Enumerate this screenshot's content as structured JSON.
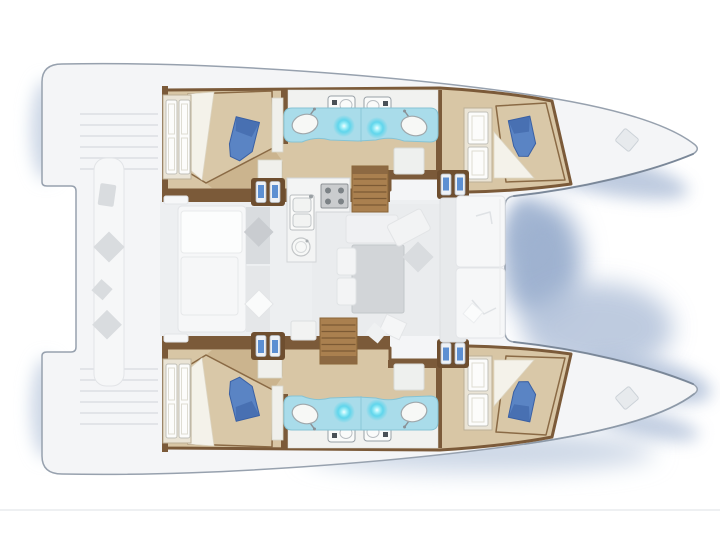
{
  "document": {
    "type": "floorplan-diagram",
    "subject": "catamaran yacht deck layout, top view",
    "orientation": "bows pointing right, twin hulls top and bottom",
    "visible_text": "none"
  },
  "colors": {
    "hullFill": "#f4f5f7",
    "hullStroke": "#97a1ae",
    "bowEdge": "#6e7c8e",
    "wallBrown": "#7b5a39",
    "floorTan": "#d8c6a5",
    "floorDark": "#c3a87e",
    "bedTan": "#d9c8a8",
    "bedOutline": "#8a6a45",
    "sheetWhite": "#f4f2ea",
    "cushionBlue": "#5a84c4",
    "cushionBlueDark": "#3a60a4",
    "wardrobeFrame": "#eae4d6",
    "doorWhite": "#fcfcfb",
    "doorStroke": "#c1c0b8",
    "bathBlue": "#a9dcea",
    "bathEdge": "#86c3d4",
    "glowCyan": "#49d7ee",
    "sinkWhite": "#f7f8f6",
    "sinkStroke": "#9fa7ab",
    "toiletWhite": "#fafbfa",
    "fixtureStroke": "#98a0a6",
    "fixtureDark": "#4a5157",
    "stepPanel": "#6e4e2f",
    "stepFace": "#eef1f5",
    "stepBlue": "#5c8fd2",
    "stairBrown": "#aa804f",
    "stairTread": "#7c5a34",
    "stairDark": "#8a6640",
    "furnWhite": "#f6f7f8",
    "furnStroke": "#e2e4e7",
    "furnGray": "#d9dcdf",
    "furnGrayDark": "#c9ccd0",
    "tableGray": "#d2d5d8",
    "stoveGray": "#caccce",
    "burnerDark": "#6f7479",
    "nightstand": "#f0f0ec",
    "deckLine": "#dcdfe3",
    "shadowDeep": "#9fb2d0",
    "shadowMid": "#b3c2da",
    "shadowLight": "#ccd7e6",
    "faintLine": "#e9ebee"
  },
  "floorplan": {
    "stern": {
      "features": [
        "swim-platform-steps-upper",
        "swim-platform-steps-lower"
      ]
    },
    "center_deck": {
      "rooms": [
        {
          "name": "aft-cockpit",
          "fixtures": [
            "long-bench",
            "scatter-cushions",
            "daybed-with-pillows"
          ]
        },
        {
          "name": "salon-galley",
          "fixtures": [
            "galley-counter",
            "double-sink",
            "stove-4-burners",
            "round-sink",
            "dining-table",
            "bench-seats",
            "chaise",
            "sideboard"
          ]
        },
        {
          "name": "forward-cockpit",
          "fixtures": [
            "bench-seat-upper",
            "bench-seat-lower"
          ]
        }
      ],
      "stairs": [
        "companionway-to-upper-hull",
        "companionway-to-lower-hull"
      ]
    },
    "hulls": [
      {
        "name": "upper-hull",
        "rooms": [
          {
            "name": "aft-cabin",
            "fixtures": [
              "double-bed",
              "wardrobe",
              "blue-cushion",
              "nightstand"
            ]
          },
          {
            "name": "bathroom",
            "fixtures": [
              "toilet",
              "toilet",
              "blue-vanity-counter",
              "washbasin",
              "washbasin",
              "shower-light",
              "shower-light"
            ]
          },
          {
            "name": "forward-cabin",
            "fixtures": [
              "double-bed",
              "wardrobe",
              "blue-cushion",
              "entry-steps"
            ]
          },
          {
            "name": "bow-deck",
            "fixtures": [
              "deck-hatch"
            ]
          }
        ]
      },
      {
        "name": "lower-hull",
        "mirror_of": "upper-hull",
        "rooms": [
          {
            "name": "aft-cabin",
            "fixtures": [
              "double-bed",
              "wardrobe",
              "blue-cushion",
              "nightstand"
            ]
          },
          {
            "name": "bathroom",
            "fixtures": [
              "toilet",
              "toilet",
              "blue-vanity-counter",
              "washbasin",
              "washbasin",
              "shower-light",
              "shower-light"
            ]
          },
          {
            "name": "forward-cabin",
            "fixtures": [
              "double-bed",
              "wardrobe",
              "blue-cushion",
              "entry-steps"
            ]
          },
          {
            "name": "bow-deck",
            "fixtures": [
              "deck-hatch"
            ]
          }
        ]
      }
    ],
    "decor": {
      "bottom_rule_line": true,
      "water_shadows": true
    }
  }
}
